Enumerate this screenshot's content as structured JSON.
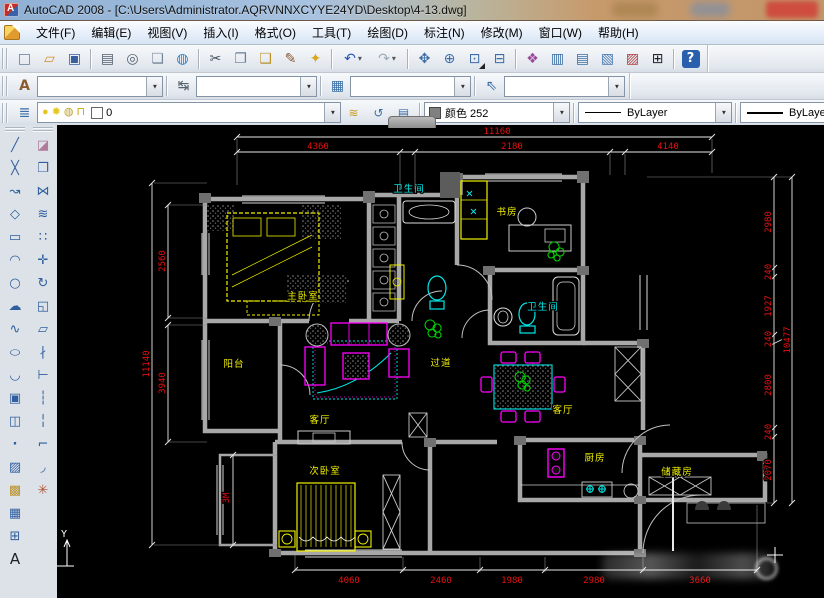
{
  "window": {
    "title": "AutoCAD 2008 - [C:\\Users\\Administrator.AQRVNNXCYYE24YD\\Desktop\\4-13.dwg]"
  },
  "menu": {
    "items": [
      "文件(F)",
      "编辑(E)",
      "视图(V)",
      "插入(I)",
      "格式(O)",
      "工具(T)",
      "绘图(D)",
      "标注(N)",
      "修改(M)",
      "窗口(W)",
      "帮助(H)"
    ]
  },
  "standard_toolbar": [
    {
      "name": "new",
      "glyph": "□"
    },
    {
      "name": "open",
      "glyph": "▱"
    },
    {
      "name": "save",
      "glyph": "▣"
    },
    {
      "name": "plot",
      "glyph": "▤"
    },
    {
      "name": "plot-preview",
      "glyph": "◎"
    },
    {
      "name": "publish",
      "glyph": "❏"
    },
    {
      "name": "3d-dwf",
      "glyph": "◍"
    },
    {
      "name": "cut",
      "glyph": "✂"
    },
    {
      "name": "copy",
      "glyph": "❐"
    },
    {
      "name": "paste",
      "glyph": "❑"
    },
    {
      "name": "match-properties",
      "glyph": "✎"
    },
    {
      "name": "block-editor",
      "glyph": "✦"
    },
    {
      "name": "undo",
      "glyph": "↶"
    },
    {
      "name": "redo",
      "glyph": "↷"
    },
    {
      "name": "pan",
      "glyph": "✥"
    },
    {
      "name": "zoom-realtime",
      "glyph": "⊕"
    },
    {
      "name": "zoom-window",
      "glyph": "⊡"
    },
    {
      "name": "zoom-previous",
      "glyph": "⊟"
    },
    {
      "name": "properties",
      "glyph": "❖"
    },
    {
      "name": "designcenter",
      "glyph": "▥"
    },
    {
      "name": "tool-palettes",
      "glyph": "▤"
    },
    {
      "name": "sheet-set-manager",
      "glyph": "▧"
    },
    {
      "name": "markup-set-manager",
      "glyph": "▨"
    },
    {
      "name": "quickcalc",
      "glyph": "⊞"
    },
    {
      "name": "help",
      "glyph": "?"
    }
  ],
  "styles_toolbar": {
    "icons": [
      {
        "name": "text-style",
        "glyph": "A"
      },
      {
        "name": "dim-style",
        "glyph": "↹"
      },
      {
        "name": "table-style",
        "glyph": "▦"
      },
      {
        "name": "mleader-style",
        "glyph": "⇖"
      }
    ]
  },
  "layers_toolbar": {
    "manager_glyph": "≣",
    "bulb": "●",
    "sun": "✹",
    "vp_freeze": "◍",
    "lock": "⊓",
    "layer_name": "0",
    "make_current": "≋",
    "previous": "↺",
    "states": "▤"
  },
  "properties_toolbar": {
    "color_label": "颜色 252",
    "linetype_label": "ByLayer",
    "lineweight_label": "ByLayer"
  },
  "draw_toolbar": [
    {
      "name": "line",
      "glyph": "╱"
    },
    {
      "name": "construction-line",
      "glyph": "╳"
    },
    {
      "name": "polyline",
      "glyph": "↝"
    },
    {
      "name": "polygon",
      "glyph": "◇"
    },
    {
      "name": "rectangle",
      "glyph": "▭"
    },
    {
      "name": "arc",
      "glyph": "◠"
    },
    {
      "name": "circle",
      "glyph": "○"
    },
    {
      "name": "revcloud",
      "glyph": "☁"
    },
    {
      "name": "spline",
      "glyph": "∿"
    },
    {
      "name": "ellipse",
      "glyph": "○"
    },
    {
      "name": "ellipse-arc",
      "glyph": "◡"
    },
    {
      "name": "insert-block",
      "glyph": "▣"
    },
    {
      "name": "make-block",
      "glyph": "◫"
    },
    {
      "name": "point",
      "glyph": "·"
    },
    {
      "name": "hatch",
      "glyph": "▨"
    },
    {
      "name": "gradient",
      "glyph": "▩"
    },
    {
      "name": "region",
      "glyph": "▦"
    },
    {
      "name": "table",
      "glyph": "⊞"
    },
    {
      "name": "mtext",
      "glyph": "A"
    }
  ],
  "modify_toolbar": [
    {
      "name": "erase",
      "glyph": "◪"
    },
    {
      "name": "copy",
      "glyph": "❐"
    },
    {
      "name": "mirror",
      "glyph": "⋈"
    },
    {
      "name": "offset",
      "glyph": "≋"
    },
    {
      "name": "array",
      "glyph": "∷"
    },
    {
      "name": "move",
      "glyph": "✛"
    },
    {
      "name": "rotate",
      "glyph": "↻"
    },
    {
      "name": "scale",
      "glyph": "◱"
    },
    {
      "name": "stretch",
      "glyph": "▱"
    },
    {
      "name": "trim",
      "glyph": "∤"
    },
    {
      "name": "extend",
      "glyph": "⊢"
    },
    {
      "name": "break-at-point",
      "glyph": "┆"
    },
    {
      "name": "break",
      "glyph": "╎"
    },
    {
      "name": "chamfer",
      "glyph": "⌐"
    },
    {
      "name": "fillet",
      "glyph": "◞"
    },
    {
      "name": "explode",
      "glyph": "✳"
    }
  ],
  "plan": {
    "labels": [
      "主卧室",
      "卫生间",
      "书房",
      "卫生间",
      "阳台",
      "客厅",
      "过道",
      "客厅",
      "次卧室",
      "厨房",
      "储藏房"
    ],
    "dims": {
      "top_total": "11160",
      "top": [
        "4360",
        "2180",
        "4140"
      ],
      "left_total": "11140",
      "left": [
        "2560",
        "3940"
      ],
      "left_small": "3M",
      "right_total": "10477",
      "right": [
        "2980",
        "240",
        "1927",
        "240",
        "2800",
        "240",
        "2070"
      ],
      "bottom": [
        "4060",
        "2460",
        "1980",
        "2980",
        "3660"
      ]
    },
    "ucs_y": "Y"
  },
  "colors": {
    "dim_red": "#e81010",
    "furniture_yellow": "#f0f000",
    "furniture_magenta": "#ff00ff",
    "fixture_cyan": "#00e8e8",
    "plant_green": "#00d000",
    "wall_grey": "#a8a8a8",
    "canvas": "#000000"
  }
}
